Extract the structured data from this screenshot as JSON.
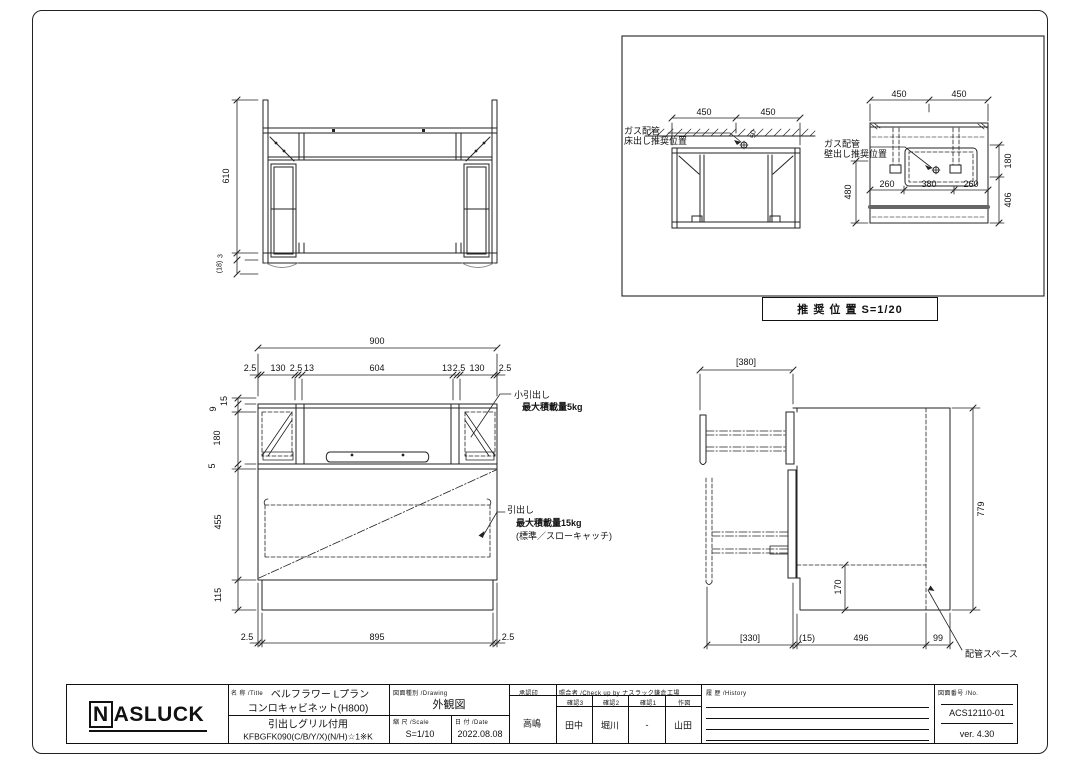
{
  "sheet": {
    "background": "#ffffff",
    "line_color": "#222222"
  },
  "views": {
    "top_view": {
      "dims": {
        "height": "610",
        "gap": "3",
        "overhang": "(18)"
      }
    },
    "recommended": {
      "box_label": "推 奨 位 置 S=1/20",
      "floor_view": {
        "note_line1": "ガス配管",
        "note_line2": "床出し推奨位置",
        "dim_left": "450",
        "dim_right": "450",
        "dim_offset": "50"
      },
      "wall_view": {
        "note_line1": "ガス配管",
        "note_line2": "壁出し推奨位置",
        "dim_top_left": "450",
        "dim_top_right": "450",
        "dim_mid": [
          "260",
          "380",
          "260"
        ],
        "dim_right": [
          "180",
          "406"
        ],
        "dim_left": "480"
      }
    },
    "front_view": {
      "dim_width": "900",
      "top_dims": [
        "2.5",
        "130",
        "2.5",
        "13",
        "604",
        "13",
        "2.5",
        "130",
        "2.5"
      ],
      "left_dims": [
        "15",
        "9",
        "180",
        "5",
        "455",
        "115"
      ],
      "bottom_dims": [
        "2.5",
        "895",
        "2.5"
      ],
      "small_drawer_note": [
        "小引出し",
        "最大積載量5kg"
      ],
      "drawer_note": [
        "引出し",
        "最大積載量15kg",
        "(標準／スローキャッチ)"
      ]
    },
    "side_view": {
      "dim_top": "[380]",
      "dim_height": "779",
      "dim_base": "170",
      "bottom_dims": [
        "[330]",
        "(15)",
        "496",
        "99"
      ],
      "piping_note": "配管スペース"
    }
  },
  "title_block": {
    "logo": {
      "n": "N",
      "rest": "ASLUCK"
    },
    "name_label": "名 称 /Title",
    "title_lines": [
      "ベルフラワー Lプラン",
      "コンロキャビネット(H800)",
      "引出しグリル付用",
      "KFBGFK090(C/B/Y/X)(N/H)☆1※K"
    ],
    "drawing_label": "図面種別 /Drawing",
    "drawing_value": "外観図",
    "scale_label": "縮 尺 /Scale",
    "scale_value": "S=1/10",
    "date_label": "日 付 /Date",
    "date_value": "2022.08.08",
    "approval_label": "承認印",
    "approval_value": "高嶋",
    "check_label": "照合者 /Check up by ナスラック鎌倉工場",
    "check_cols": [
      {
        "label": "確認3",
        "value": "田中"
      },
      {
        "label": "確認2",
        "value": "堀川"
      },
      {
        "label": "確認1",
        "value": "-"
      },
      {
        "label": "作図",
        "value": "山田"
      }
    ],
    "history_label": "履 歴 /History",
    "no_label": "図面番号 /No.",
    "no_value": "ACS12110-01",
    "version": "ver. 4.30"
  }
}
